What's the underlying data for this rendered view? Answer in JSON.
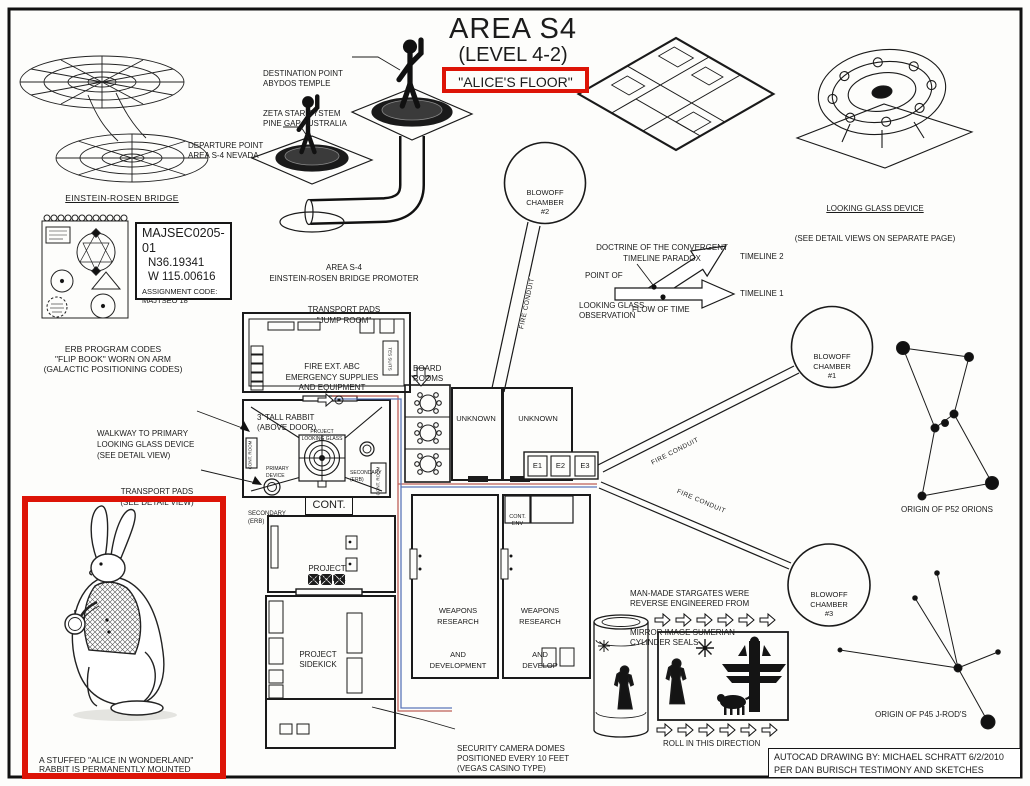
{
  "colors": {
    "paper": "#fdfdfb",
    "ink": "#1b1b1b",
    "highlight_red": "#dd1407",
    "conduit_red": "#b2443a",
    "conduit_blue": "#3f5fae"
  },
  "title": {
    "l1": "AREA S4",
    "l2": "(LEVEL 4-2)",
    "l3": "\"ALICE'S FLOOR\""
  },
  "top_left": {
    "bridge_caption": "EINSTEIN-ROSEN BRIDGE",
    "flipbook": [
      "ERB PROGRAM CODES",
      "\"FLIP BOOK\" WORN ON ARM",
      "(GALACTIC POSITIONING CODES)"
    ],
    "majsec": [
      "MAJSEC0205-01",
      "N36.19341",
      "W 115.00616",
      "ASSIGNMENT CODE:",
      "MAJTSEO 18"
    ]
  },
  "jump_room": {
    "destination": [
      "DESTINATION POINT",
      "ABYDOS TEMPLE",
      "ZETA STAR SYSTEM",
      "PINE GAP AUSTRALIA"
    ],
    "departure": [
      "DEPARTURE POINT",
      "AREA S-4 NEVADA"
    ],
    "caption": [
      "AREA S-4",
      "EINSTEIN-ROSEN BRIDGE PROMOTER",
      "TRANSPORT PADS",
      "\"JUMP ROOM\""
    ]
  },
  "looking_glass": {
    "caption": "LOOKING GLASS DEVICE",
    "note": "(SEE DETAIL VIEWS ON SEPARATE PAGE)"
  },
  "timeline": {
    "title": [
      "DOCTRINE OF THE CONVERGENT",
      "TIMELINE PARADOX"
    ],
    "point": [
      "POINT OF",
      "LOOKING GLASS",
      "OBSERVATION"
    ],
    "t2": "TIMELINE 2",
    "t1": "TIMELINE 1",
    "flow": "FLOW OF TIME"
  },
  "chambers": {
    "c1": [
      "BLOWOFF",
      "CHAMBER",
      "#1"
    ],
    "c2": [
      "BLOWOFF",
      "CHAMBER",
      "#2"
    ],
    "c3": [
      "BLOWOFF",
      "CHAMBER",
      "#3"
    ],
    "conduit": "FIRE CONDUIT"
  },
  "plan": {
    "fire_ext": [
      "FIRE EXT. ABC",
      "EMERGENCY SUPPLIES",
      "AND EQUIPMENT"
    ],
    "tes": "TES SUITS",
    "board": [
      "BOARD",
      "ROOMS"
    ],
    "rabbit_note": [
      "3' TALL RABBIT",
      "(ABOVE DOOR)"
    ],
    "plg": [
      "PROJECT",
      "LOOKING GLASS"
    ],
    "primary": [
      "PRIMARY",
      "DEVICE"
    ],
    "secondary": [
      "SECONDARY",
      "(ERB)"
    ],
    "cont_room": "CONT. ROOM",
    "cont": "CONT.",
    "sidekick": [
      "PROJECT",
      "SIDEKICK"
    ],
    "unknown": "UNKNOWN",
    "e": [
      "E1",
      "E2",
      "E3"
    ],
    "cont_env": [
      "CONT.",
      "ENV"
    ],
    "weapons1": [
      "WEAPONS",
      "RESEARCH",
      "AND",
      "DEVELOPMENT"
    ],
    "weapons2": [
      "WEAPONS",
      "RESEARCH",
      "AND",
      "DEVELOP"
    ]
  },
  "notes": {
    "walkway": [
      "WALKWAY TO PRIMARY",
      "LOOKING GLASS DEVICE",
      "(SEE DETAIL VIEW)"
    ],
    "transport": [
      "TRANSPORT PADS",
      "(SEE DETAIL VIEW)"
    ],
    "security": [
      "SECURITY CAMERA DOMES",
      "POSITIONED EVERY 10 FEET",
      "(VEGAS CASINO TYPE)"
    ],
    "stargates": [
      "MAN-MADE STARGATES WERE",
      "REVERSE ENGINEERED FROM",
      "MIRROR IMAGE SUMERIAN",
      "CYLINDER SEALS"
    ],
    "roll": "ROLL IN THIS DIRECTION",
    "orion": "ORIGIN OF P52 ORIONS",
    "jrod": "ORIGIN OF P45 J-ROD'S"
  },
  "rabbit_box": {
    "caption": [
      "A STUFFED \"ALICE IN WONDERLAND\"",
      "RABBIT IS PERMANENTLY MOUNTED",
      "ABOVE THE ENTRANCE TO THE",
      "PROJECT LOOKING GLASS ROOM"
    ]
  },
  "credit": [
    "AUTOCAD DRAWING BY: MICHAEL SCHRATT 6/2/2010",
    "PER DAN BURISCH TESTIMONY AND SKETCHES"
  ]
}
